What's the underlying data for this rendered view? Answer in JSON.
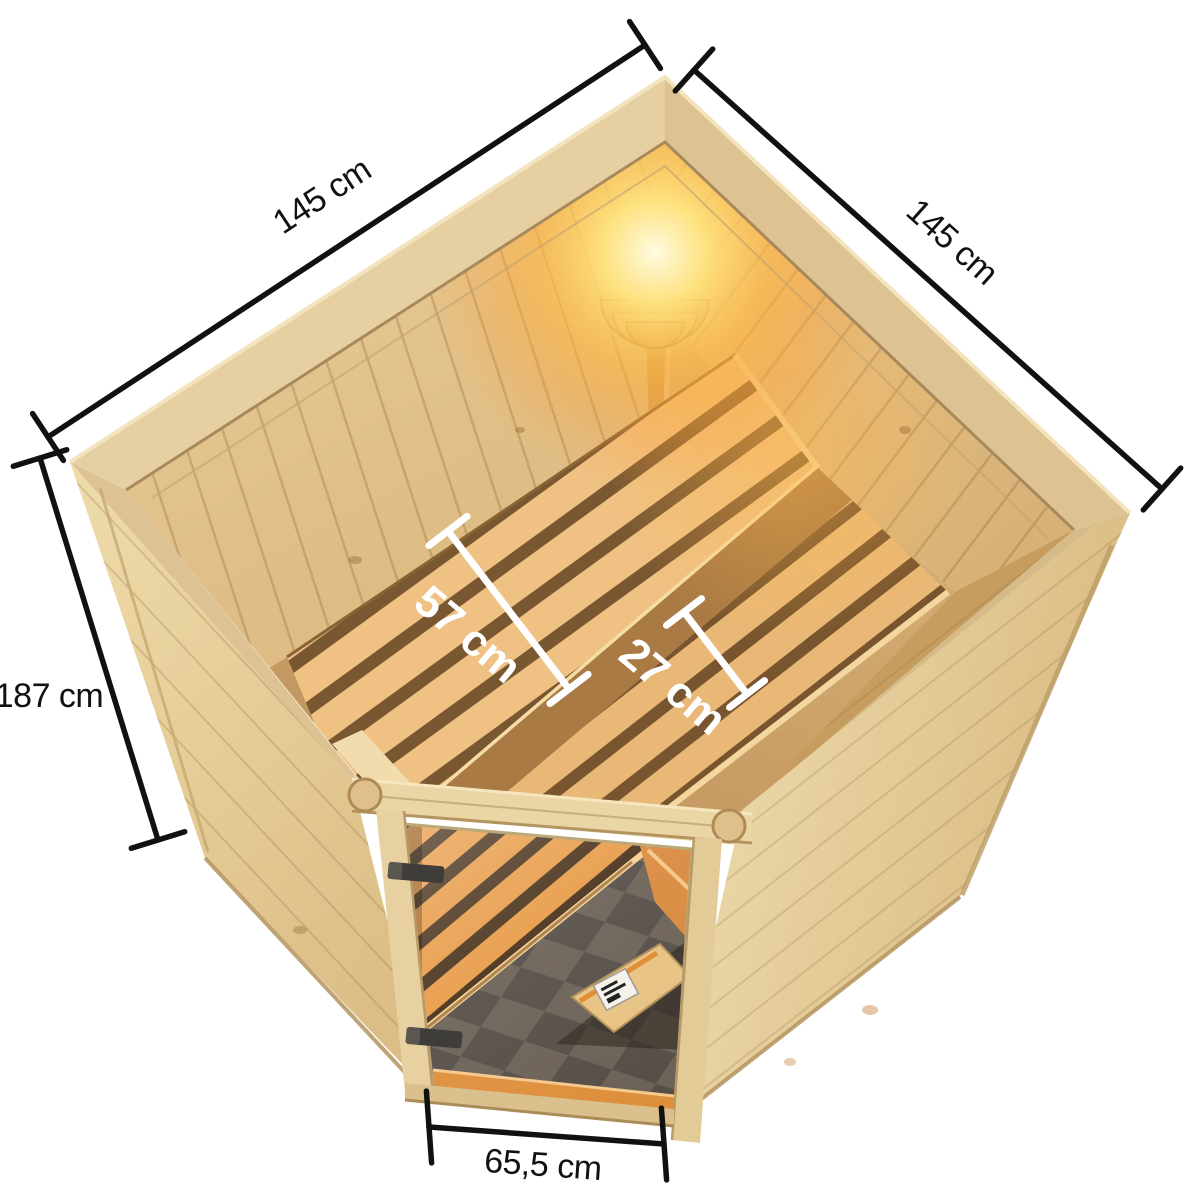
{
  "figure": {
    "type": "product-dimension-diagram",
    "subject": "corner sauna with interior benches, corner lamp and bronze glass door, viewed from above",
    "background_color": "#ffffff",
    "line_color": "#111111",
    "interior_label_color": "#ffffff"
  },
  "dimensions": {
    "left_width": {
      "label": "145 cm",
      "edge": "back-left wall outer width"
    },
    "right_width": {
      "label": "145 cm",
      "edge": "back-right wall outer width"
    },
    "height": {
      "label": "187 cm",
      "edge": "wall height"
    },
    "main_bench_depth": {
      "label": "57 cm",
      "edge": "upper bench depth"
    },
    "step_bench_depth": {
      "label": "27 cm",
      "edge": "lower step bench depth"
    },
    "door_width": {
      "label": "65,5 cm",
      "edge": "glass door width"
    }
  },
  "palette": {
    "wood_light": "#eedcae",
    "wood_mid": "#e3c793",
    "wood_shadow": "#c9a26a",
    "bench_slat": "#efc183",
    "slat_gap": "#5f3f1f",
    "lamp_glow": "#ffc23e",
    "glass_floor_dark": "#5a524a",
    "glass_floor_light": "#6f655a",
    "glass_bench_orange": "#e89a45"
  }
}
